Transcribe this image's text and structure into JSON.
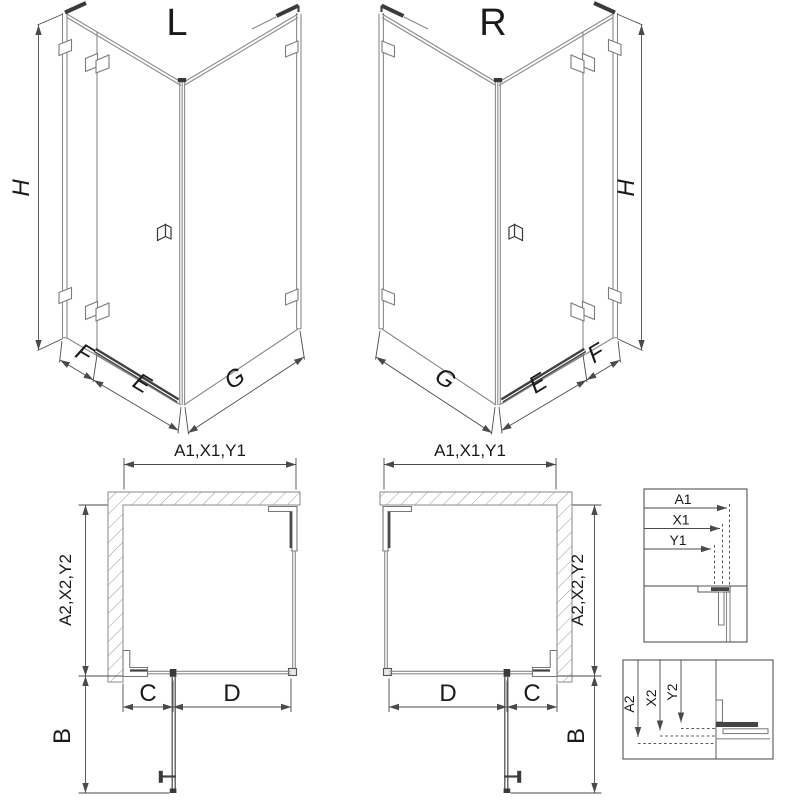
{
  "title_labels": {
    "left": "L",
    "right": "R"
  },
  "iso_dimension_labels": {
    "height": "H",
    "wall_segment": "F",
    "door_width": "E",
    "side_panel": "G"
  },
  "plan_dimension_labels": {
    "overall_width": "A1,X1,Y1",
    "overall_depth": "A2,X2,Y2",
    "door_opening": "B",
    "segment_c": "C",
    "segment_d": "D"
  },
  "detail_views": {
    "top": {
      "labels": [
        "A1",
        "X1",
        "Y1"
      ]
    },
    "bottom": {
      "labels": [
        "A2",
        "X2",
        "Y2"
      ]
    }
  },
  "colors": {
    "glass_line": "#8a8a8a",
    "dark_line": "#3a3a3a",
    "dimension_line": "#4a4a4a",
    "text": "#1a1a1a",
    "background": "#ffffff"
  }
}
